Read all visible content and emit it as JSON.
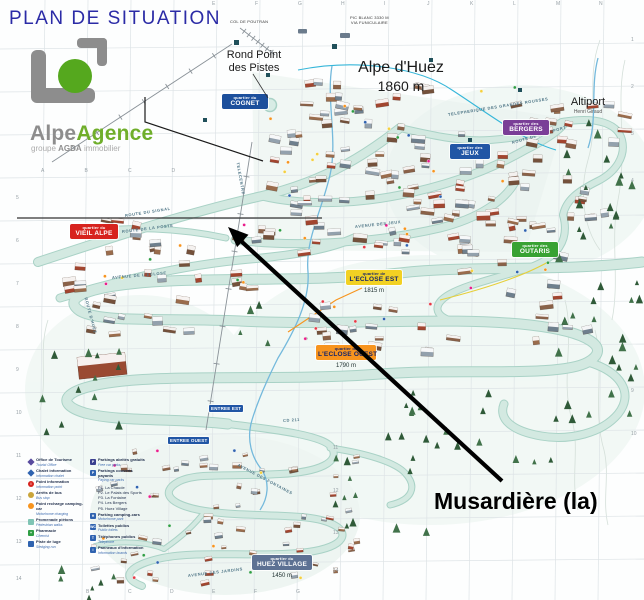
{
  "title": "PLAN DE SITUATION",
  "logo": {
    "name_grey": "Alpe",
    "name_green": "Agence",
    "subtitle_pre": "groupe",
    "subtitle_bold": "AGDA",
    "subtitle_post": "immobilier"
  },
  "annotation": {
    "label": "Musardière (la)"
  },
  "map": {
    "resort": {
      "name": "Alpe d'Huez",
      "altitude": "1860 m"
    },
    "rond_point": {
      "line1": "Rond Point",
      "line2": "des Pistes"
    },
    "altiport": {
      "name": "Altiport",
      "sub": "Henri Giraud"
    },
    "peaks": {
      "col": "COL DE POUTRAN",
      "pic_line1": "PIC BLANC 3330 M",
      "pic_line2": "VIA FUNICULAIRE"
    },
    "quarters": [
      {
        "prefix": "quartier du",
        "name": "COGNET",
        "bg": "#1c4f9c",
        "fg": "#ffffff",
        "x": 222,
        "y": 94,
        "w": 42
      },
      {
        "prefix": "quartier des",
        "name": "JEUX",
        "bg": "#2156a5",
        "fg": "#ffffff",
        "x": 450,
        "y": 144,
        "w": 36
      },
      {
        "prefix": "quartier des",
        "name": "BERGERS",
        "bg": "#7a3e97",
        "fg": "#ffffff",
        "x": 503,
        "y": 120,
        "w": 42
      },
      {
        "prefix": "quartier du",
        "name": "VIEIL ALPE",
        "bg": "#d7231e",
        "fg": "#ffffff",
        "x": 70,
        "y": 224,
        "w": 44
      },
      {
        "prefix": "quartier des",
        "name": "OUTARIS",
        "bg": "#38a233",
        "fg": "#ffffff",
        "x": 512,
        "y": 242,
        "w": 42
      },
      {
        "prefix": "quartier de",
        "name": "L'ECLOSE EST",
        "bg": "#f2d123",
        "fg": "#15246b",
        "x": 346,
        "y": 270,
        "w": 52,
        "altitude": "1815 m"
      },
      {
        "prefix": "quartier de",
        "name": "L'ECLOSE OUEST",
        "bg": "#f7941e",
        "fg": "#15246b",
        "x": 316,
        "y": 345,
        "w": 56,
        "altitude": "1790 m"
      },
      {
        "prefix": "quartier du",
        "name": "HUEZ VILLAGE",
        "bg": "#5d7193",
        "fg": "#ffffff",
        "x": 252,
        "y": 555,
        "w": 56,
        "altitude": "1450 m"
      }
    ],
    "entrances": [
      {
        "label": "ENTREE EST",
        "x": 209,
        "y": 405
      },
      {
        "label": "ENTREE OUEST",
        "x": 168,
        "y": 437
      }
    ],
    "streets": [
      {
        "name": "ROUTE DU SIGNAL",
        "x": 125,
        "y": 213,
        "r": -9
      },
      {
        "name": "ROUTE DE LA POSTE",
        "x": 122,
        "y": 229,
        "r": -7
      },
      {
        "name": "AVENUE DE L'ECLOSE",
        "x": 112,
        "y": 275,
        "r": -5
      },
      {
        "name": "ROUTE D'HUEZ",
        "x": 86,
        "y": 295,
        "r": 75
      },
      {
        "name": "AVENUE DES JEUX",
        "x": 355,
        "y": 224,
        "r": -6
      },
      {
        "name": "ROUTE DE L'ALTIPORT",
        "x": 512,
        "y": 140,
        "r": -16
      },
      {
        "name": "TELEPHERIQUE DES GRANDES ROUSSES",
        "x": 448,
        "y": 112,
        "r": -9
      },
      {
        "name": "TELECENTRE",
        "x": 238,
        "y": 160,
        "r": 80
      },
      {
        "name": "CD 211",
        "x": 283,
        "y": 418,
        "r": -4
      },
      {
        "name": "AVENUE DES JARDINS",
        "x": 188,
        "y": 573,
        "r": -7
      },
      {
        "name": "AVENUE DES FONTAINES",
        "x": 238,
        "y": 462,
        "r": 28
      }
    ],
    "grid": {
      "top_letters": [
        "E",
        "F",
        "G",
        "H",
        "I",
        "J",
        "K",
        "L",
        "M",
        "N"
      ],
      "mid_letters": [
        "A",
        "B",
        "C",
        "D"
      ],
      "bottom_letters": [
        "B",
        "C",
        "D",
        "E",
        "F",
        "G"
      ],
      "left_numbers": [
        "5",
        "6",
        "7",
        "8",
        "9",
        "10",
        "11",
        "12",
        "13",
        "14"
      ],
      "right_numbers": [
        "1",
        "2",
        "3",
        "4",
        "9",
        "10"
      ],
      "inner_numbers": [
        "11",
        "12",
        "13",
        "14"
      ]
    }
  },
  "legend": {
    "col1": [
      {
        "shape": "diamond",
        "color": "#584a9e",
        "label": "Office de Tourisme",
        "sub": "Tourist Office"
      },
      {
        "shape": "diamond",
        "color": "#2f63b0",
        "label": "Chalet information",
        "sub": "Information chalet"
      },
      {
        "shape": "circle",
        "color": "#d7231e",
        "glyph": "i",
        "label": "Point information",
        "sub": "Information point"
      },
      {
        "shape": "circle",
        "color": "#caa53a",
        "label": "Arrêts de bus",
        "sub": "Bus stop"
      },
      {
        "shape": "circle",
        "color": "#f7941e",
        "label": "Point recharge camping-car",
        "sub": "Motorhome charging"
      },
      {
        "shape": "square",
        "color": "#7fc4b4",
        "label": "Promenade piétons",
        "sub": "Pedestrian walks"
      },
      {
        "shape": "square",
        "color": "#2f9e44",
        "glyph": "+",
        "label": "Pharmacie",
        "sub": "Chemist"
      },
      {
        "shape": "square",
        "color": "#2f63b0",
        "label": "Piste de luge",
        "sub": "Sledging run"
      }
    ],
    "col2": [
      {
        "shape": "square",
        "color": "#3a3f8f",
        "glyph": "P",
        "label": "Parkings abrités gratuits",
        "sub": "Free car parks"
      },
      {
        "shape": "square",
        "color": "#2f63b0",
        "glyph": "P",
        "label": "Parkings couverts payants",
        "sub": "Paying car parks"
      },
      {
        "lines": [
          "P1. La Chaude",
          "P2. Le Palais des Sports",
          "P3. La Fontaine",
          "P4. Les Bergers",
          "P5. Huez Village"
        ]
      },
      {
        "shape": "square",
        "color": "#2f63b0",
        "glyph": "H",
        "label": "Parking camping-cars",
        "sub": "Motorhome park"
      },
      {
        "shape": "square",
        "color": "#2f63b0",
        "glyph": "WC",
        "label": "Toilettes publics",
        "sub": "Public toilets"
      },
      {
        "shape": "square",
        "color": "#2f63b0",
        "glyph": "T",
        "label": "Téléphones publics",
        "sub": "Telephone"
      },
      {
        "shape": "square",
        "color": "#2f63b0",
        "glyph": "i",
        "label": "Panneaux d'information",
        "sub": "Information boards"
      }
    ]
  }
}
